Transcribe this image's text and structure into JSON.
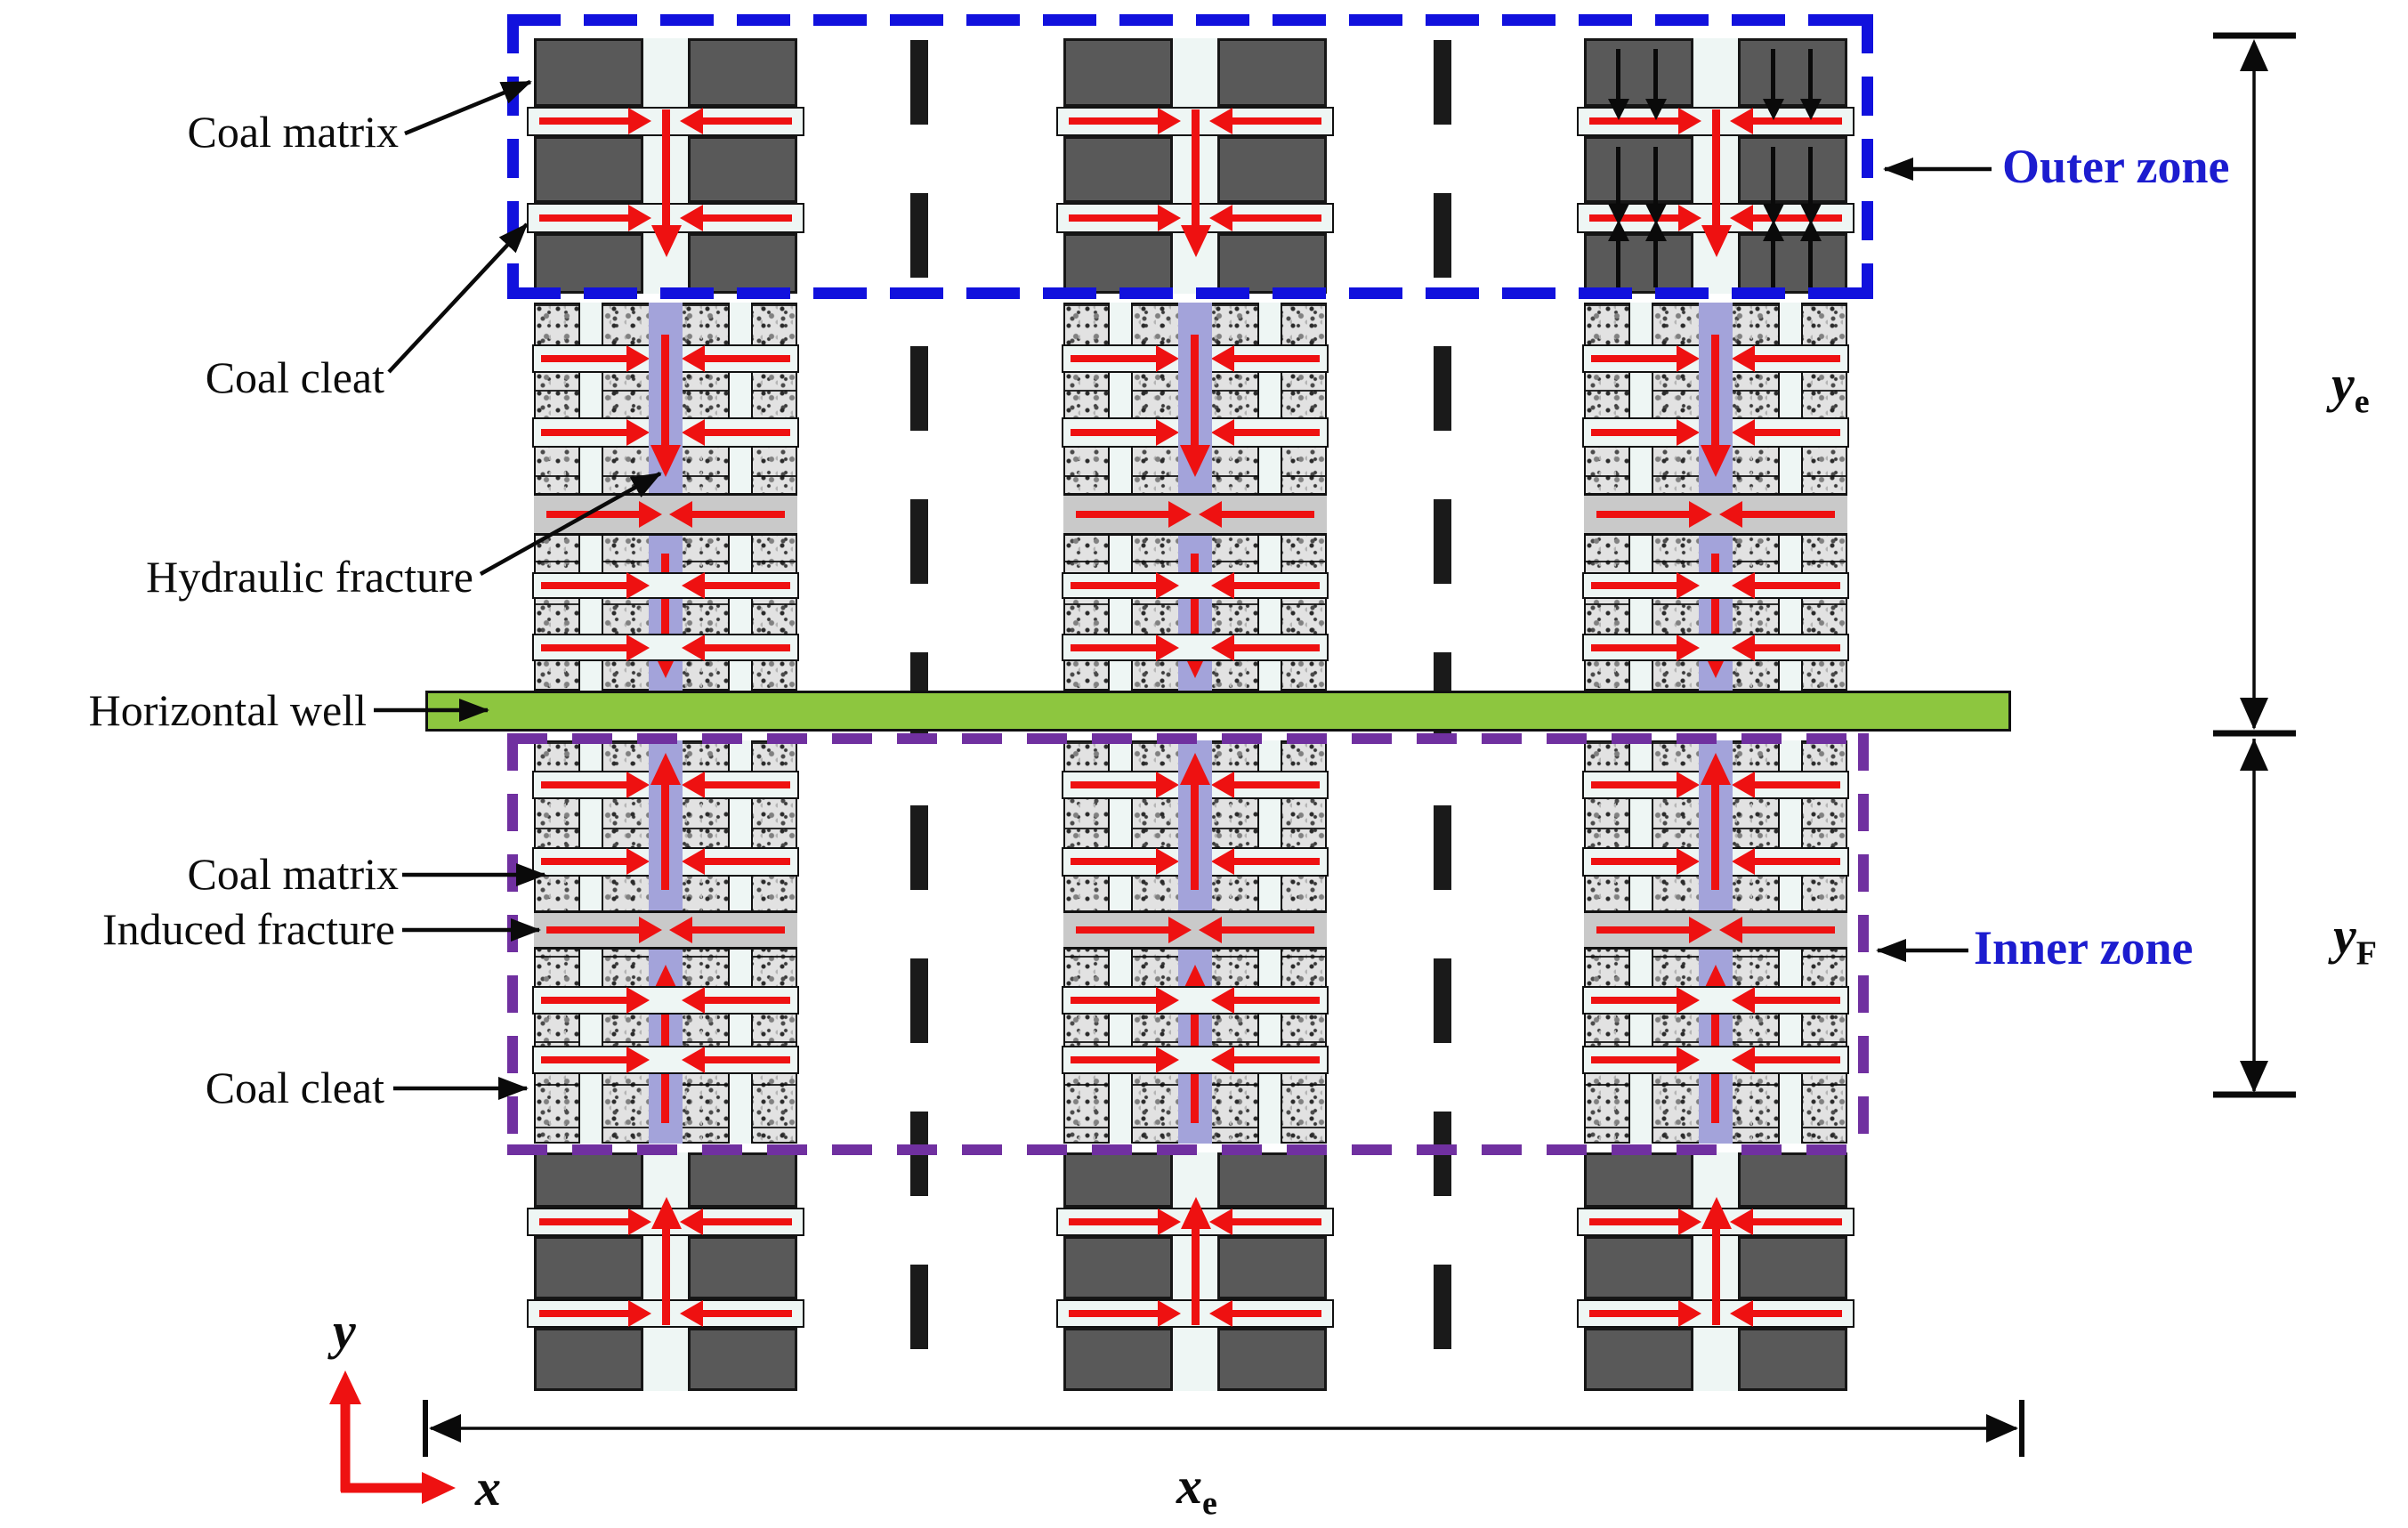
{
  "diagram": {
    "title": "Multi-stage fractured horizontal well in coal seam — physical model",
    "annotations": {
      "coal_matrix_top": "Coal matrix",
      "coal_cleat_top": "Coal cleat",
      "hydraulic_fracture": "Hydraulic fracture",
      "horizontal_well": "Horizontal well",
      "coal_matrix_inner": "Coal matrix",
      "induced_fracture": "Induced fracture",
      "coal_cleat_inner": "Coal cleat",
      "outer_zone": "Outer zone",
      "inner_zone": "Inner zone"
    },
    "dimensions": {
      "ye": {
        "base": "y",
        "sub": "e"
      },
      "yF": {
        "base": "y",
        "sub": "F"
      },
      "xe": {
        "base": "x",
        "sub": "e"
      }
    },
    "axes": {
      "x_label": "x",
      "y_label": "y"
    },
    "colors": {
      "coal_matrix_dark": "#595959",
      "cleat_channel": "#eef6f4",
      "hydraulic_fracture_fill": "#a3a3da",
      "induced_fracture_fill": "#c9c9c9",
      "well_green": "#8dc63f",
      "flow_arrow_red": "#ee1111",
      "outer_zone_blue": "#1111dd",
      "inner_zone_purple": "#7030a0",
      "separator_black": "#1a1a1a",
      "zone_label_blue": "#1c1ccf"
    },
    "columns": [
      {
        "name": "fracture-stage-1",
        "black_arrows": false
      },
      {
        "name": "fracture-stage-2",
        "black_arrows": false
      },
      {
        "name": "fracture-stage-3",
        "black_arrows": true
      }
    ]
  }
}
